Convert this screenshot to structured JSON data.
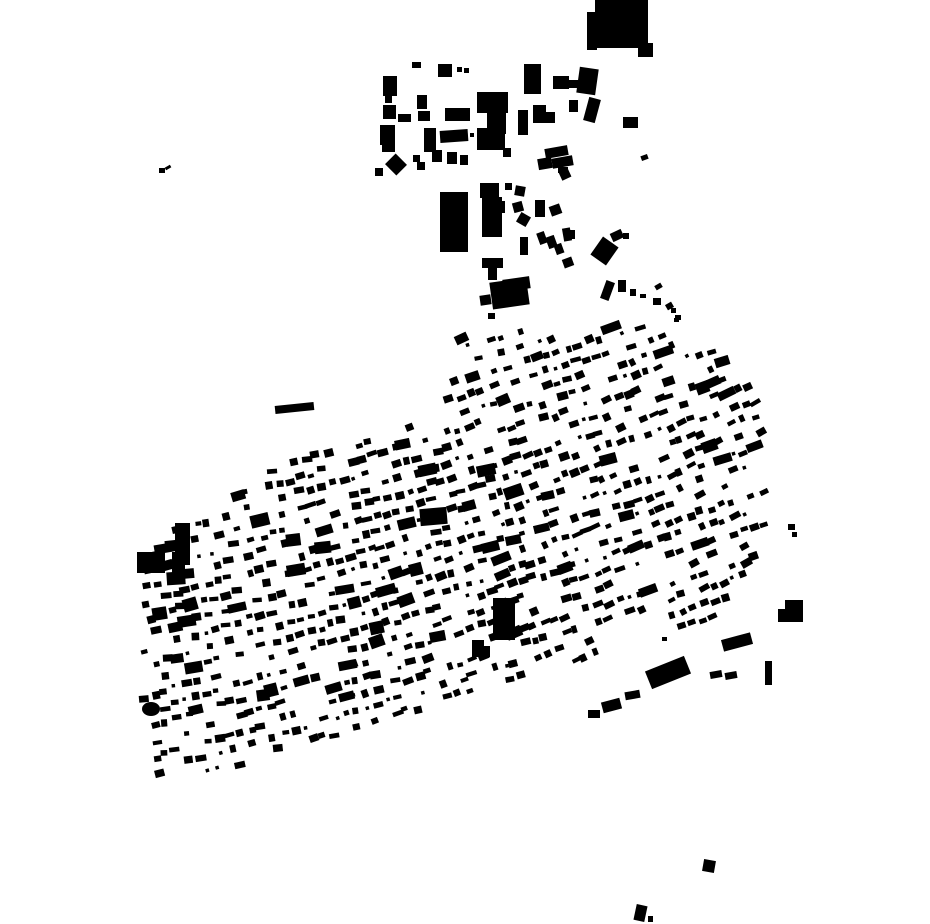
{
  "canvas": {
    "width": 930,
    "height": 924,
    "background": "#ffffff",
    "building_color": "#000000"
  },
  "map_type": "figure-ground building footprint map",
  "buildings_format": [
    "x",
    "y",
    "w",
    "h",
    "rotate_deg"
  ],
  "explicit_buildings": [
    [
      595,
      0,
      53,
      48,
      0
    ],
    [
      587,
      12,
      10,
      38,
      0
    ],
    [
      638,
      43,
      15,
      14,
      0
    ],
    [
      412,
      62,
      9,
      6,
      0
    ],
    [
      438,
      64,
      14,
      13,
      0
    ],
    [
      457,
      67,
      5,
      5,
      0
    ],
    [
      464,
      68,
      5,
      5,
      0
    ],
    [
      383,
      76,
      14,
      20,
      0
    ],
    [
      524,
      64,
      17,
      30,
      0
    ],
    [
      553,
      76,
      16,
      13,
      0
    ],
    [
      568,
      80,
      10,
      8,
      0
    ],
    [
      578,
      68,
      19,
      26,
      8
    ],
    [
      385,
      96,
      7,
      7,
      0
    ],
    [
      417,
      95,
      10,
      14,
      0
    ],
    [
      477,
      92,
      31,
      21,
      0
    ],
    [
      487,
      112,
      19,
      22,
      0
    ],
    [
      383,
      105,
      13,
      14,
      0
    ],
    [
      398,
      114,
      13,
      8,
      0
    ],
    [
      418,
      111,
      12,
      10,
      0
    ],
    [
      445,
      108,
      25,
      13,
      0
    ],
    [
      533,
      105,
      13,
      18,
      0
    ],
    [
      545,
      112,
      10,
      11,
      0
    ],
    [
      518,
      110,
      10,
      25,
      0
    ],
    [
      569,
      100,
      9,
      12,
      0
    ],
    [
      586,
      98,
      12,
      24,
      15
    ],
    [
      623,
      117,
      15,
      11,
      0
    ],
    [
      380,
      125,
      15,
      20,
      0
    ],
    [
      424,
      128,
      12,
      24,
      0
    ],
    [
      382,
      140,
      13,
      12,
      0
    ],
    [
      440,
      130,
      28,
      12,
      -4
    ],
    [
      470,
      133,
      4,
      4,
      0
    ],
    [
      477,
      128,
      28,
      22,
      0
    ],
    [
      503,
      148,
      8,
      9,
      0
    ],
    [
      545,
      147,
      23,
      10,
      -10
    ],
    [
      552,
      157,
      21,
      10,
      -10
    ],
    [
      538,
      158,
      14,
      11,
      -10
    ],
    [
      432,
      150,
      10,
      12,
      0
    ],
    [
      447,
      152,
      10,
      12,
      0
    ],
    [
      460,
      155,
      8,
      10,
      0
    ],
    [
      413,
      155,
      7,
      7,
      0
    ],
    [
      388,
      157,
      16,
      15,
      45
    ],
    [
      375,
      168,
      8,
      8,
      0
    ],
    [
      417,
      162,
      8,
      8,
      0
    ],
    [
      558,
      167,
      10,
      6,
      0
    ],
    [
      641,
      155,
      7,
      5,
      -20
    ],
    [
      560,
      170,
      10,
      9,
      -25
    ],
    [
      440,
      192,
      28,
      60,
      0
    ],
    [
      480,
      183,
      19,
      15,
      0
    ],
    [
      482,
      197,
      20,
      40,
      0
    ],
    [
      498,
      201,
      7,
      12,
      0
    ],
    [
      505,
      183,
      7,
      7,
      0
    ],
    [
      515,
      186,
      10,
      10,
      10
    ],
    [
      513,
      202,
      10,
      10,
      -15
    ],
    [
      518,
      214,
      11,
      11,
      30
    ],
    [
      535,
      200,
      10,
      17,
      0
    ],
    [
      550,
      205,
      11,
      10,
      -20
    ],
    [
      563,
      228,
      8,
      13,
      -10
    ],
    [
      520,
      237,
      8,
      18,
      0
    ],
    [
      538,
      232,
      8,
      12,
      -20
    ],
    [
      547,
      236,
      9,
      12,
      -20
    ],
    [
      555,
      244,
      8,
      10,
      -20
    ],
    [
      565,
      230,
      10,
      9,
      0
    ],
    [
      482,
      258,
      21,
      10,
      0
    ],
    [
      488,
      268,
      9,
      12,
      0
    ],
    [
      503,
      278,
      27,
      12,
      -8
    ],
    [
      563,
      258,
      10,
      9,
      -20
    ],
    [
      595,
      240,
      19,
      22,
      35
    ],
    [
      611,
      231,
      12,
      9,
      -25
    ],
    [
      623,
      233,
      6,
      6,
      0
    ],
    [
      491,
      280,
      37,
      27,
      -8
    ],
    [
      480,
      295,
      11,
      10,
      -8
    ],
    [
      488,
      313,
      7,
      6,
      0
    ],
    [
      603,
      281,
      9,
      19,
      20
    ],
    [
      618,
      280,
      8,
      12,
      0
    ],
    [
      630,
      289,
      6,
      7,
      0
    ],
    [
      640,
      294,
      6,
      4,
      0
    ],
    [
      655,
      284,
      7,
      5,
      -30
    ],
    [
      653,
      298,
      8,
      7,
      0
    ],
    [
      666,
      303,
      7,
      6,
      -30
    ],
    [
      671,
      308,
      5,
      5,
      0
    ],
    [
      675,
      315,
      6,
      5,
      0
    ],
    [
      601,
      323,
      20,
      9,
      -20
    ],
    [
      455,
      334,
      13,
      9,
      -25
    ],
    [
      674,
      318,
      5,
      4,
      0
    ],
    [
      159,
      168,
      6,
      5,
      0
    ],
    [
      165,
      166,
      6,
      3,
      -30
    ],
    [
      275,
      404,
      39,
      8,
      -6
    ],
    [
      647,
      663,
      42,
      19,
      -22
    ],
    [
      722,
      636,
      30,
      12,
      -15
    ],
    [
      785,
      600,
      18,
      22,
      0
    ],
    [
      778,
      609,
      9,
      13,
      0
    ],
    [
      765,
      661,
      7,
      24,
      0
    ],
    [
      662,
      637,
      5,
      4,
      0
    ],
    [
      710,
      671,
      12,
      7,
      -10
    ],
    [
      725,
      672,
      12,
      7,
      -10
    ],
    [
      625,
      691,
      15,
      8,
      -10
    ],
    [
      602,
      700,
      19,
      11,
      -15
    ],
    [
      588,
      710,
      12,
      8,
      0
    ],
    [
      703,
      860,
      12,
      12,
      10
    ],
    [
      635,
      905,
      11,
      16,
      12
    ],
    [
      648,
      916,
      5,
      6,
      0
    ],
    [
      788,
      524,
      7,
      6,
      0
    ],
    [
      792,
      532,
      5,
      5,
      0
    ],
    [
      175,
      523,
      15,
      42,
      0
    ],
    [
      172,
      552,
      13,
      30,
      0
    ],
    [
      137,
      552,
      28,
      21,
      0
    ],
    [
      420,
      508,
      27,
      17,
      -5
    ],
    [
      493,
      598,
      22,
      42,
      0
    ],
    [
      472,
      640,
      12,
      17,
      0
    ],
    [
      482,
      646,
      8,
      11,
      0
    ]
  ],
  "ellipses": [
    {
      "cx": 151,
      "cy": 709,
      "rx": 9,
      "ry": 7
    }
  ],
  "fabric": {
    "seed": 1337,
    "polygon": [
      [
        148,
        548
      ],
      [
        255,
        478
      ],
      [
        312,
        452
      ],
      [
        398,
        422
      ],
      [
        442,
        398
      ],
      [
        462,
        345
      ],
      [
        520,
        331
      ],
      [
        575,
        334
      ],
      [
        608,
        323
      ],
      [
        648,
        328
      ],
      [
        700,
        340
      ],
      [
        756,
        388
      ],
      [
        768,
        440
      ],
      [
        766,
        545
      ],
      [
        758,
        580
      ],
      [
        742,
        602
      ],
      [
        700,
        624
      ],
      [
        652,
        630
      ],
      [
        598,
        654
      ],
      [
        548,
        668
      ],
      [
        492,
        686
      ],
      [
        448,
        700
      ],
      [
        412,
        712
      ],
      [
        348,
        740
      ],
      [
        282,
        760
      ],
      [
        208,
        774
      ],
      [
        154,
        778
      ],
      [
        143,
        720
      ],
      [
        137,
        610
      ]
    ],
    "grid_angle_deg": -17,
    "row_pitch": 15,
    "col_pitch": 11,
    "pos_jitter": 2.5,
    "rot_jitter": 7,
    "angle_base": -8,
    "angle_slope_per_px": -0.026,
    "angle_min": -26,
    "angle_max": -6,
    "fill_prob": 0.7,
    "dense_region": {
      "x1": 350,
      "y1": 470,
      "x2": 580,
      "y2": 640,
      "fill_prob": 0.81
    },
    "size": {
      "min_w": 5,
      "max_w": 11,
      "min_h": 4,
      "max_h": 8
    },
    "large_prob": 0.07,
    "large_size": {
      "min_w": 12,
      "max_w": 20,
      "min_h": 8,
      "max_h": 13
    },
    "tiny_prob": 0.08,
    "tiny_size": 3.5,
    "street_mod": 23
  }
}
